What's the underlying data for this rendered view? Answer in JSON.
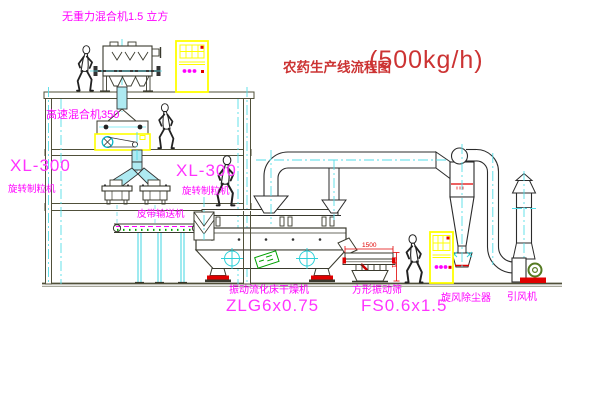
{
  "title": {
    "cn": "农药生产线流程图",
    "capacity": "(500kg/h)"
  },
  "labels": {
    "gravity_mixer": "无重力混合机1.5 立方",
    "high_speed_mixer": "高速混合机350",
    "granulator_left_model": "XL-300",
    "granulator_left_name": "旋转制粒机",
    "granulator_mid_model": "XL-300",
    "granulator_mid_name": "旋转制粒机",
    "belt_conveyor": "皮带输送机",
    "dryer_name": "振动流化床干燥机",
    "dryer_model": "ZLG6x0.75",
    "screen_name": "方形振动筛",
    "screen_model": "FS0.6x1.5",
    "cyclone": "旋风除尘器",
    "fan": "引风机"
  },
  "dimensions": {
    "screen_length": "1500",
    "screen_height": "541"
  },
  "colors": {
    "label_magenta": "#ff00ff",
    "title_red": "#cc3333",
    "cabinet_yellow": "#ffff00",
    "centerline_cyan": "#55dde8",
    "structure_olive": "#50503a",
    "accent_red": "#e00000",
    "conveyor_green": "#00a000"
  }
}
